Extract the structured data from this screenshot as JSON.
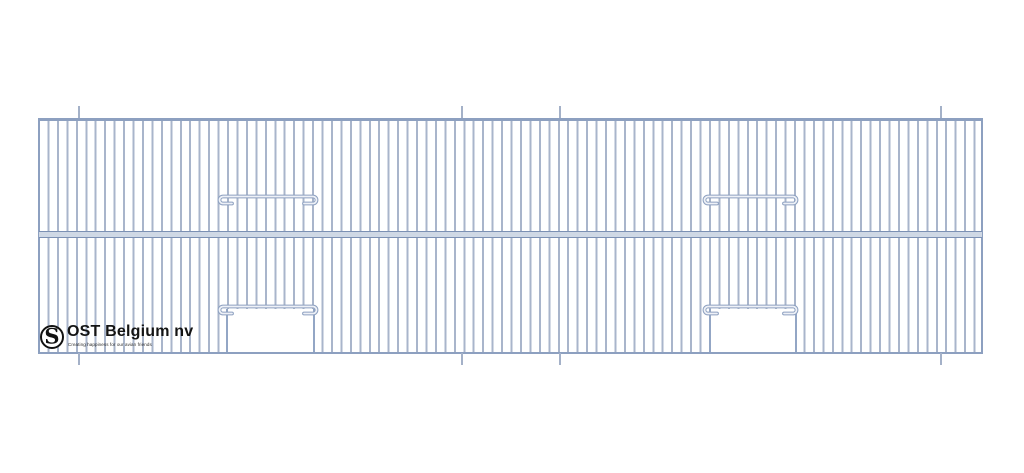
{
  "page": {
    "background": "#ffffff",
    "description": "Technical line drawing of a wire cage front panel with vertical bars, a horizontal middle rail, two upper door wires and two lower door openings"
  },
  "colors": {
    "bar": "#a9b5cb",
    "frame": "#8da0c0",
    "rail_fill": "#cfd8e5",
    "rail_edge": "#7b90b4",
    "wire_outer": "#8da0c0",
    "wire_inner": "#eef1f7",
    "tick": "#a4b1c8",
    "opening_border": "#93a6c5",
    "logo_text": "#141414"
  },
  "logo": {
    "monogram": "S",
    "name": "OST Belgium nv",
    "tagline": "Creating happiness for our avian friends"
  },
  "drawing": {
    "type": "cage-front-panel",
    "panel": {
      "x": 38,
      "y": 118,
      "width": 945,
      "height": 236,
      "border_side": 2.5,
      "border_top": 3,
      "border_bottom": 2.5,
      "bar_spacing": 9.45,
      "bar_width": 2,
      "bar_offset": 7.45
    },
    "mid_rail": {
      "x": 39,
      "y": 231,
      "width": 943,
      "height": 7,
      "edge": 1.5
    },
    "ticks": {
      "xs": [
        79,
        462,
        560,
        941
      ],
      "top_y": 106,
      "bottom_y": 353,
      "length": 12,
      "width": 1.5
    },
    "doors": [
      {
        "id": "upper-left-door-wire",
        "wire_x": 216,
        "wire_y": 193,
        "wire_length": 104,
        "opening": null
      },
      {
        "id": "upper-right-door-wire",
        "wire_x": 701,
        "wire_y": 193,
        "wire_length": 99,
        "opening": null
      },
      {
        "id": "lower-left-door-wire",
        "wire_x": 216,
        "wire_y": 303,
        "wire_length": 104,
        "opening": {
          "x": 226,
          "y": 308.5,
          "width": 89,
          "height": 43
        }
      },
      {
        "id": "lower-right-door-wire",
        "wire_x": 701,
        "wire_y": 303,
        "wire_length": 99,
        "opening": {
          "x": 709,
          "y": 308.5,
          "width": 88,
          "height": 43
        }
      }
    ]
  }
}
